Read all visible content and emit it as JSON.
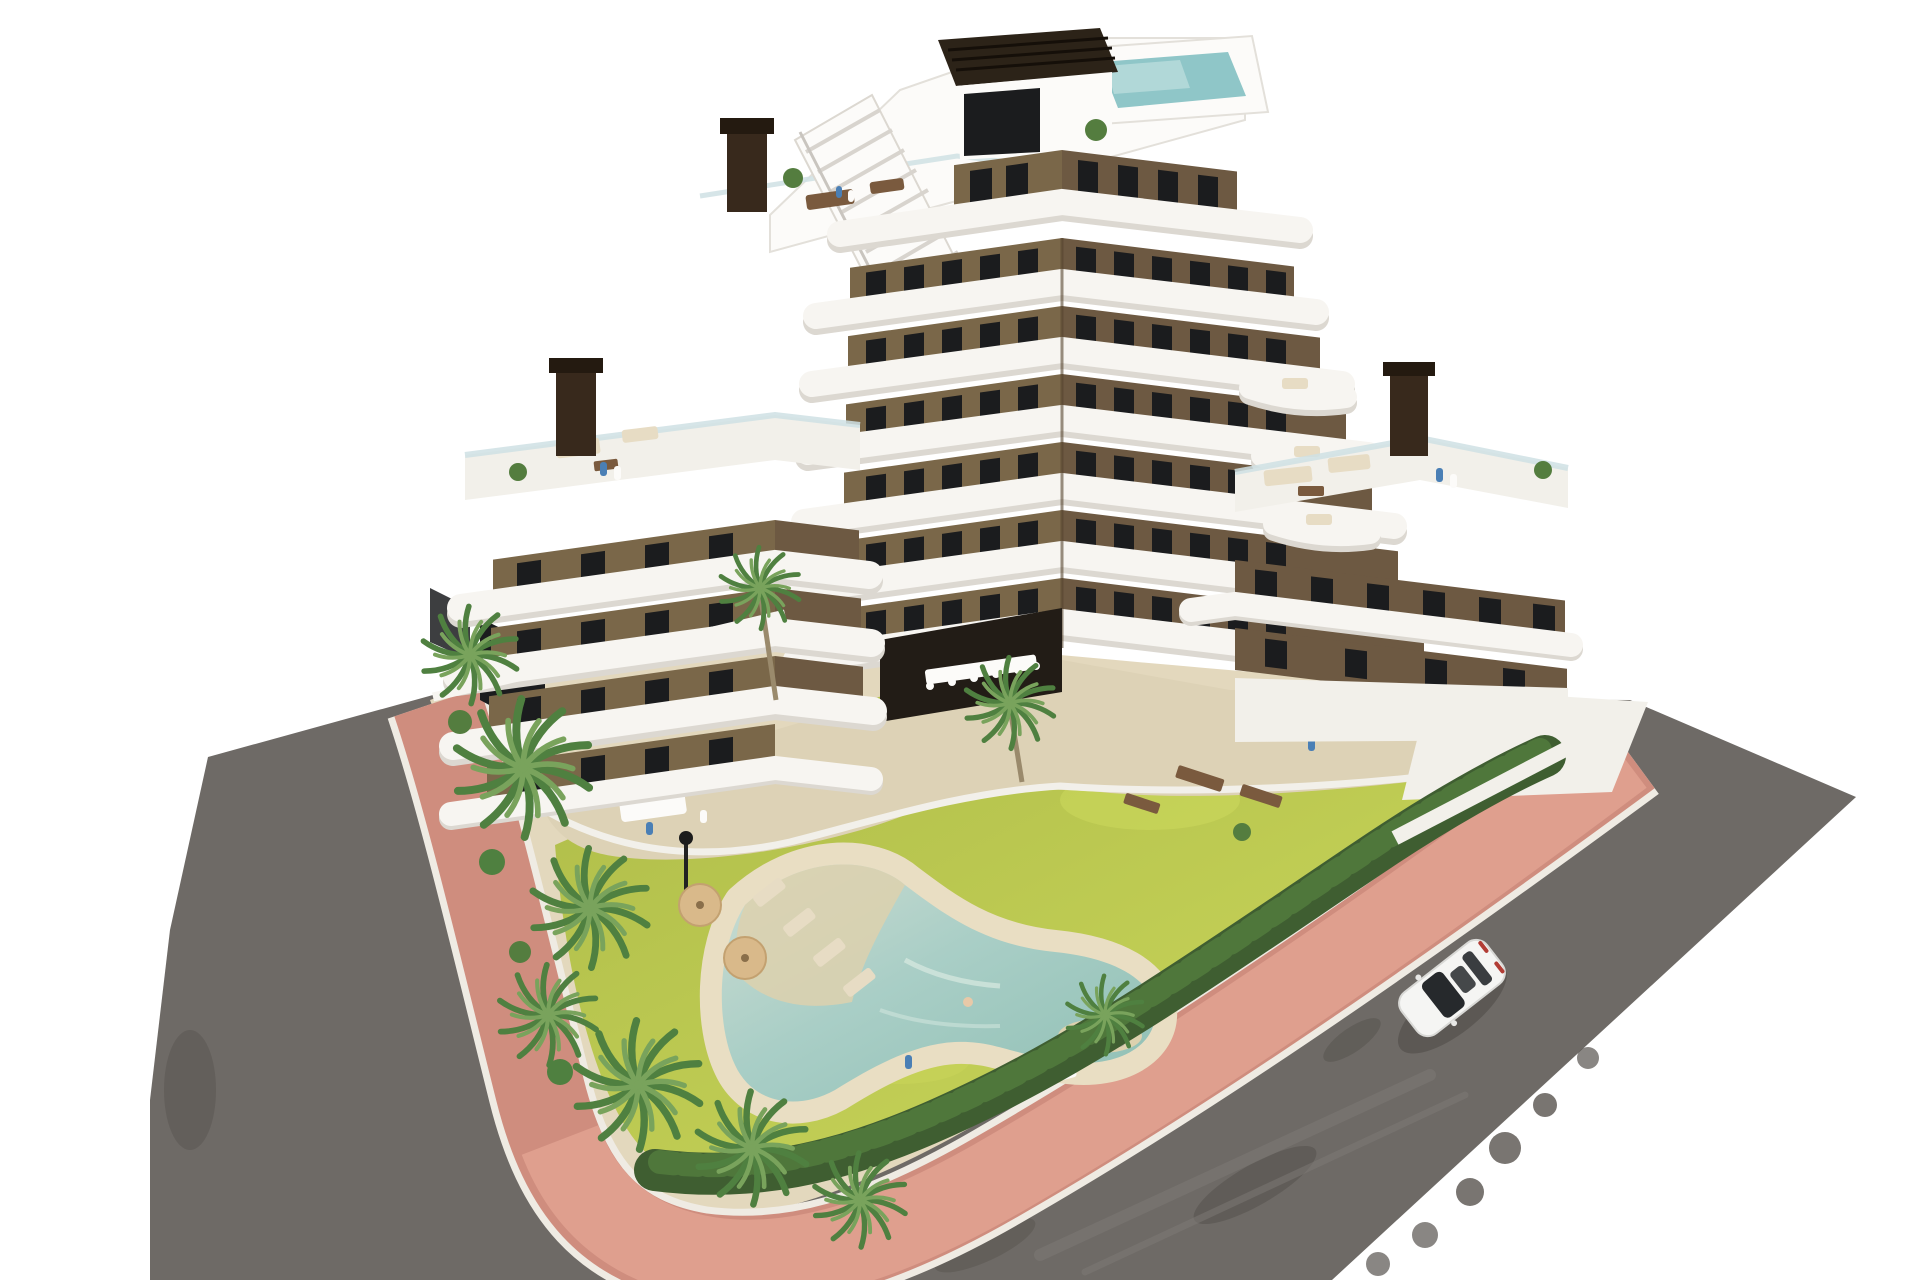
{
  "scene": {
    "description": "Aerial 3D architectural rendering of a stepped modern apartment building (dark brown facades with curved white balcony bands) on a corner plot with landscaped garden, lagoon-style pool, palm trees, pink perimeter sidewalk, asphalt roads and a single white car",
    "background": "plain white studio backdrop",
    "labels": {
      "building": "seven-storey apartment building with curved white balconies",
      "rooftop": "roof deck with pergola, stairs and small plunge pool",
      "left_terrace": "large private terrace with outdoor lounge furniture",
      "right_terrace": "large private terrace with sofas and residents",
      "courtyard": "recessed ground-floor courtyard with long dining table",
      "garden": "landscaped garden with lawn and palm trees",
      "pool": "free-form lagoon pool with beach entry and sun loungers",
      "hedge": "trimmed green perimeter hedge",
      "sidewalk": "pink paved sidewalk wrapping the corner plot",
      "road_left": "asphalt road on the left side",
      "road_right": "asphalt road on the right side",
      "car": "white sedan driving on the right road"
    },
    "counts": {
      "visible_floor_levels": 7,
      "palm_trees": 10,
      "pool_umbrellas": 2,
      "cars": 1,
      "chimneys": 4
    },
    "car": {
      "color": "white",
      "type": "sedan",
      "heading": "toward lower-left"
    }
  },
  "palette": {
    "bg": "#ffffff",
    "road": "#6e6a66",
    "road_dark": "#57534e",
    "road_light": "#7e7a76",
    "pink": "#cf8d7e",
    "pink_light": "#e2a492",
    "curb": "#efebe3",
    "sand": "#e3d8bd",
    "lawn": "#b9c64f",
    "lawn_light": "#ccd85c",
    "hedge": "#3f5e31",
    "hedge_light": "#547d3f",
    "palm_mid": "#4f8040",
    "palm_light": "#79a35c",
    "pool_water": "#a9cec6",
    "pool_deck": "#e9dec3",
    "beach": "#ddd1ae",
    "wall_left": "#7a6749",
    "wall_right": "#6d5942",
    "window": "#1b1c1e",
    "slab": "#f7f5f1",
    "slab_shadow": "#dcd8d1",
    "terrace": "#f2f0ea",
    "apron": "#ddd2b6",
    "wood": "#7a5a3e",
    "chimney": "#38291c",
    "pergola": "#2c2318",
    "glass": "#cfe0e4",
    "roof_pool": "#8fc6c8",
    "car_body": "#f5f5f3",
    "car_glass": "#26292c",
    "umbrella": "#d9b98a",
    "furn": "#e7dcc4",
    "people_blue": "#4a7fb5",
    "shadow": "rgba(40,36,32,0.25)"
  }
}
